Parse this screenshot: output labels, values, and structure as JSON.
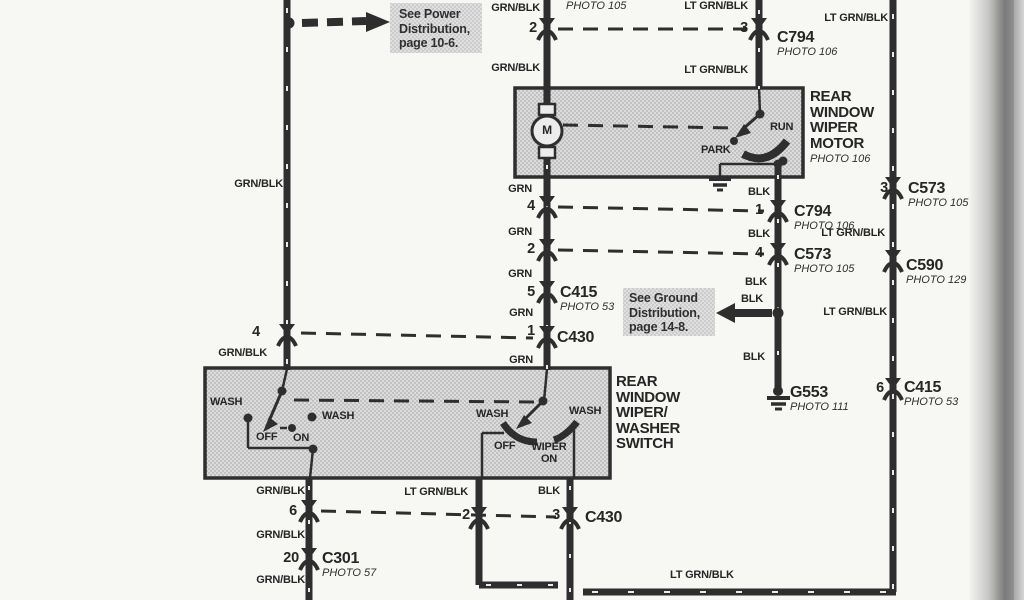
{
  "callouts": {
    "power": "See Power\nDistribution,\npage 10-6.",
    "ground": "See Ground\nDistribution,\npage 14-8."
  },
  "wire_labels": {
    "grn_blk": "GRN/BLK",
    "lt_grn_blk": "LT GRN/BLK",
    "grn": "GRN",
    "blk": "BLK"
  },
  "components": {
    "rear_window_wiper_motor": {
      "name": "REAR\nWINDOW\nWIPER\nMOTOR",
      "photo": "PHOTO 106",
      "motor_letter": "M",
      "run": "RUN",
      "park": "PARK"
    },
    "rear_window_wiper_washer_switch": {
      "name": "REAR\nWINDOW\nWIPER/\nWASHER\nSWITCH",
      "wash": "WASH",
      "off": "OFF",
      "on": "ON",
      "wiper_on": "WIPER\nON"
    }
  },
  "connectors": {
    "c794": {
      "name": "C794",
      "photo": "PHOTO 106"
    },
    "c573": {
      "name": "C573",
      "photo": "PHOTO 105"
    },
    "c590": {
      "name": "C590",
      "photo": "PHOTO 129"
    },
    "c415": {
      "name": "C415",
      "photo": "PHOTO 53"
    },
    "c430": {
      "name": "C430"
    },
    "c301": {
      "name": "C301",
      "photo": "PHOTO 57"
    },
    "photo_105_partial": "PHOTO 105"
  },
  "grounds": {
    "g553": {
      "name": "G553",
      "photo": "PHOTO 111"
    }
  },
  "pins": {
    "p1": "1",
    "p2": "2",
    "p3": "3",
    "p4": "4",
    "p5": "5",
    "p6": "6",
    "p20": "20"
  }
}
